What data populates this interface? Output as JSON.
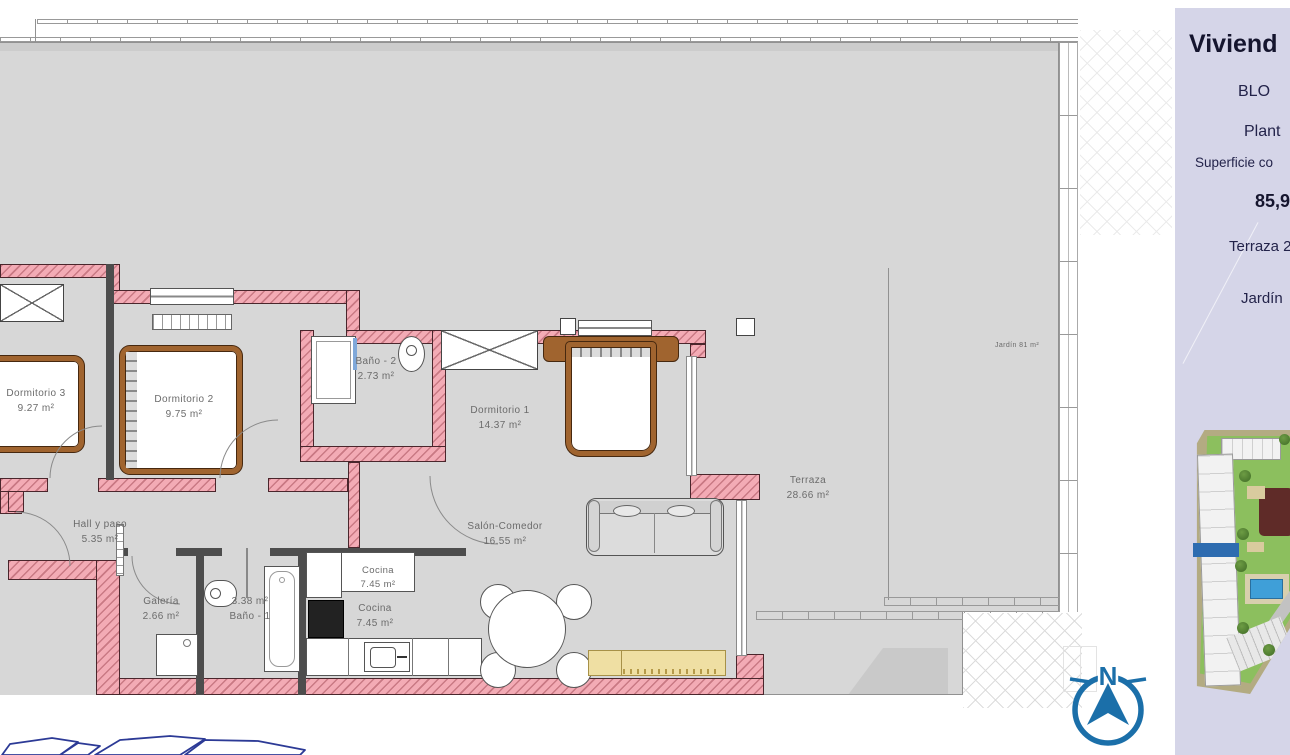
{
  "plan": {
    "rooms": [
      {
        "label": "Dormitorio 3",
        "area": "9.27 m²"
      },
      {
        "label": "Dormitorio 2",
        "area": "9.75 m²"
      },
      {
        "label": "Baño - 2",
        "area": "2.73 m²"
      },
      {
        "label": "Dormitorio 1",
        "area": "14.37 m²"
      },
      {
        "label": "Hall y paso",
        "area": "5.35 m²"
      },
      {
        "label": "Galería",
        "area": "2.66 m²"
      },
      {
        "label": "Baño - 1",
        "area": "3.38 m²"
      },
      {
        "label": "Cocina",
        "area": "7.45 m²"
      },
      {
        "label": "Cocina",
        "area": "7.45 m²"
      },
      {
        "label": "Salón-Comedor",
        "area": "16.55 m²"
      },
      {
        "label": "Terraza",
        "area": "28.66 m²"
      },
      {
        "label": "Jardín",
        "area": "81 m²"
      }
    ],
    "compass": {
      "label": "N"
    }
  },
  "sidebar": {
    "title": "Viviend",
    "line_bloque": "BLO",
    "line_planta": "Plant",
    "line_superficie": "Superficie co",
    "line_superficie_value": "85,9",
    "line_terraza": "Terraza 2",
    "line_jardin": "Jardín"
  },
  "colors": {
    "wall_pink": "#f3abb5",
    "floor_gray": "#d7d7d7",
    "wood_brown": "#a0642f",
    "sideboard_yellow": "#efdfa3",
    "compass_blue": "#1b6fa9",
    "sidebar_lavender": "#d5d5e8",
    "marker_blue": "#2e6cb0"
  }
}
